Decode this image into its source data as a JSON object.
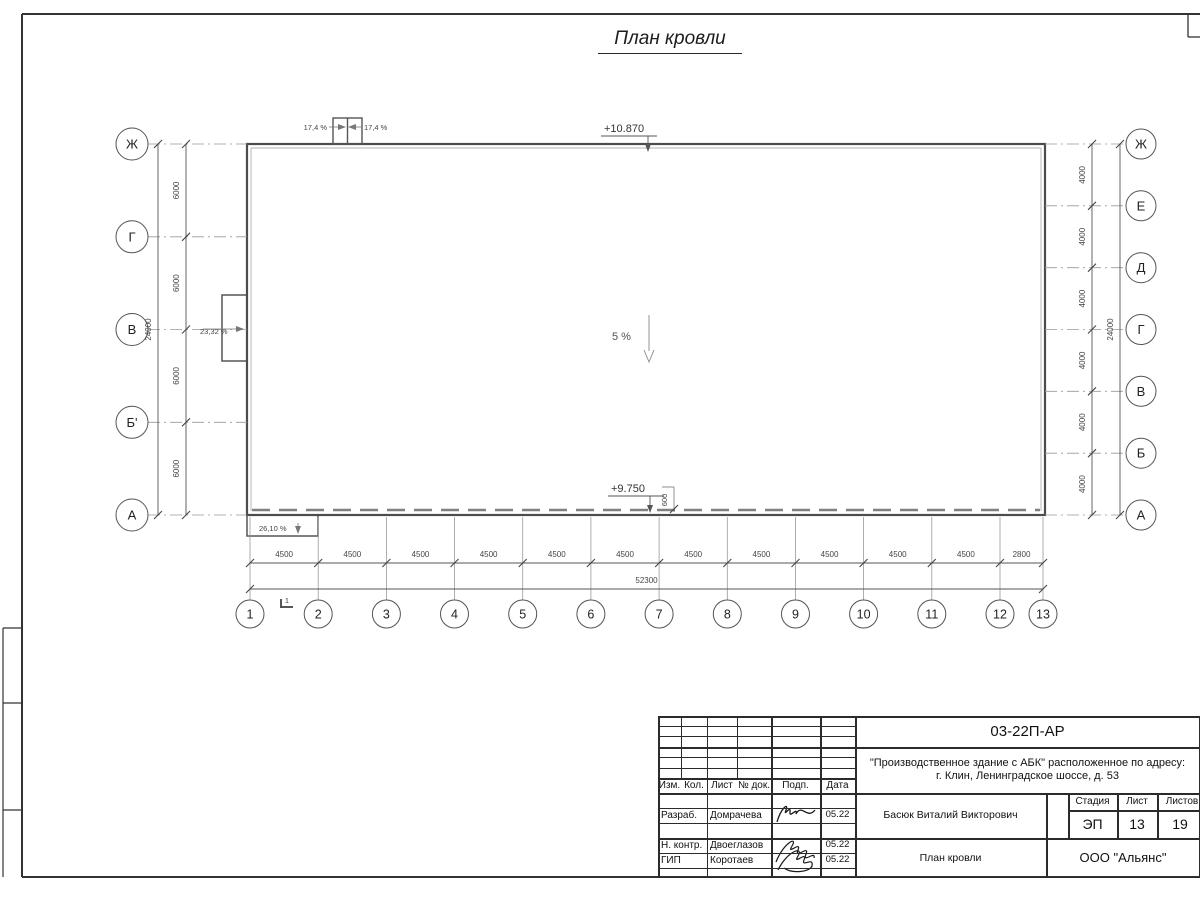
{
  "sheet": {
    "title": "План кровли"
  },
  "plan": {
    "elevation_top": "+10.870",
    "elevation_bottom": "+9.750",
    "slope_center": "5 %",
    "slope_left_wall": "23,32 %",
    "slope_canopy": "26,10 %",
    "slope_shaft_left": "17,4 %",
    "slope_shaft_right": "17,4 %",
    "dim_600": "600",
    "section_mark": "1",
    "axes_left": {
      "labels": [
        "Ж",
        "Г",
        "В",
        "Б'",
        "А"
      ],
      "segment_dims": [
        "6000",
        "6000",
        "6000",
        "6000"
      ],
      "total_dim": "24000"
    },
    "axes_right": {
      "labels": [
        "Ж",
        "Е",
        "Д",
        "Г",
        "В",
        "Б",
        "А"
      ],
      "segment_dims": [
        "4000",
        "4000",
        "4000",
        "4000",
        "4000",
        "4000"
      ],
      "total_dim": "24000"
    },
    "axes_bottom": {
      "labels": [
        "1",
        "2",
        "3",
        "4",
        "5",
        "6",
        "7",
        "8",
        "9",
        "10",
        "11",
        "12",
        "13"
      ],
      "segment_dims": [
        "4500",
        "4500",
        "4500",
        "4500",
        "4500",
        "4500",
        "4500",
        "4500",
        "4500",
        "4500",
        "4500",
        "2800"
      ],
      "total_dim": "52300"
    }
  },
  "title_block": {
    "doc_number": "03-22П-АР",
    "project_line1": "\"Производственное здание с АБК\" расположенное по адресу:",
    "project_line2": "г. Клин, Ленинградское шоссе, д. 53",
    "approver": "Басюк Виталий Викторович",
    "sheet_title": "План кровли",
    "company": "ООО \"Альянс\"",
    "stage_label": "Стадия",
    "stage_value": "ЭП",
    "sheet_label": "Лист",
    "sheet_value": "13",
    "sheets_label": "Листов",
    "sheets_value": "19",
    "header_cols": [
      "Изм.",
      "Кол.",
      "Лист",
      "№ док.",
      "Подп.",
      "Дата"
    ],
    "rows": [
      {
        "role": "Разраб.",
        "name": "Домрачева",
        "date": "05.22"
      },
      {
        "role": "Н. контр.",
        "name": "Двоеглазов",
        "date": "05.22"
      },
      {
        "role": "ГИП",
        "name": "Коротаев",
        "date": "05.22"
      }
    ]
  }
}
